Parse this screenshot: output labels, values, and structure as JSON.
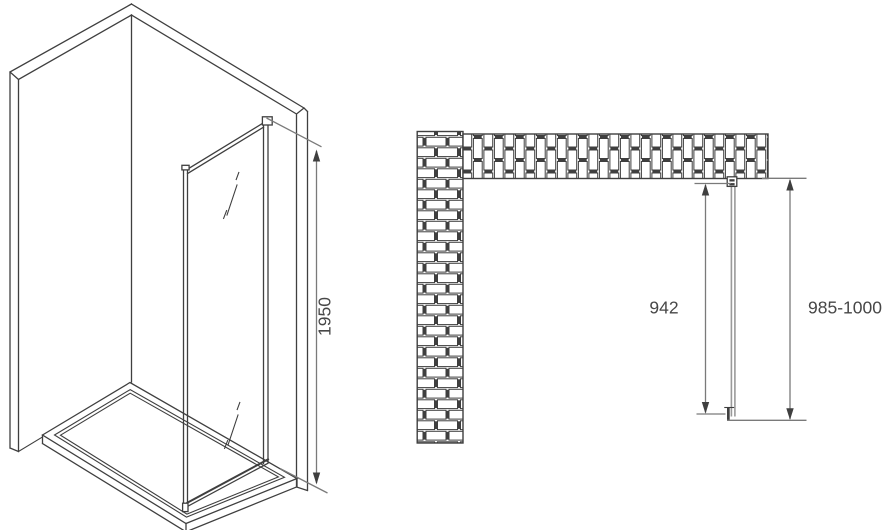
{
  "isometric_view": {
    "height_dimension_label": "1950"
  },
  "plan_view": {
    "glass_width_dimension_label": "942",
    "overall_width_dimension_label": "985-1000"
  },
  "colors": {
    "line": "#3f3f3f",
    "dimension": "#7a7a7a",
    "glass": "#9a9a9a",
    "text": "#474747",
    "background": "#ffffff"
  }
}
